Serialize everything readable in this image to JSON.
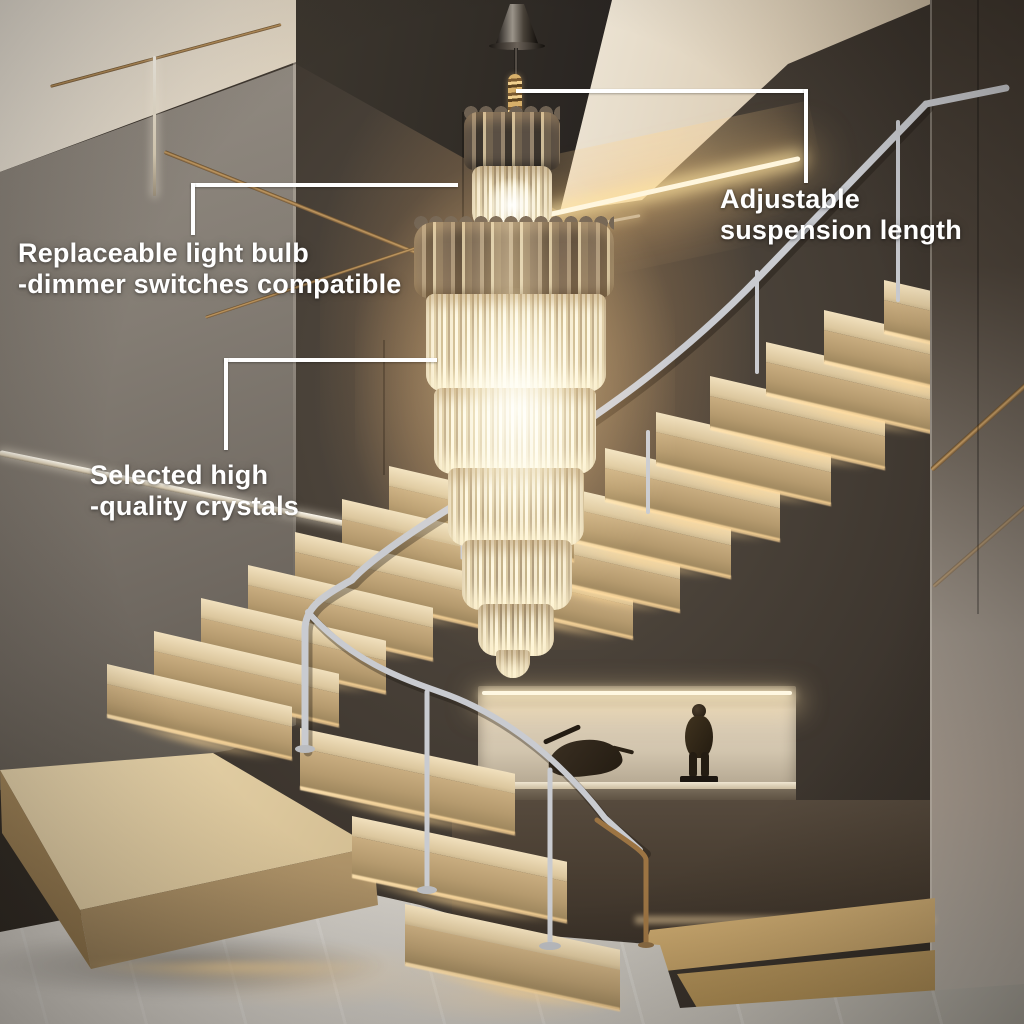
{
  "annotations": {
    "replaceable_bulb": {
      "line1": "Replaceable light bulb",
      "line2": "-dimmer switches compatible"
    },
    "adjustable_suspension": {
      "line1": "Adjustable",
      "line2": "suspension length"
    },
    "selected_crystals": {
      "line1": "Selected high",
      "line2": "-quality crystals"
    }
  },
  "colors": {
    "annotation_text": "#ffffff",
    "callout_line": "#ffffff",
    "ceiling_cream": "#efe8da",
    "wall_dark_brown": "#3f3831",
    "wall_gray": "#7f7870",
    "wood_tread": "#d9c49c",
    "under_step_glow": "#ffd9a4",
    "led_strip": "#fff6dd",
    "marble_floor": "#cac6bf",
    "steel_railing": "#c9cbd0",
    "bronze_trim": "#9c7443",
    "chandelier_crystal": "#f2e7cd",
    "chandelier_smoke_glass": "#5d5248"
  }
}
